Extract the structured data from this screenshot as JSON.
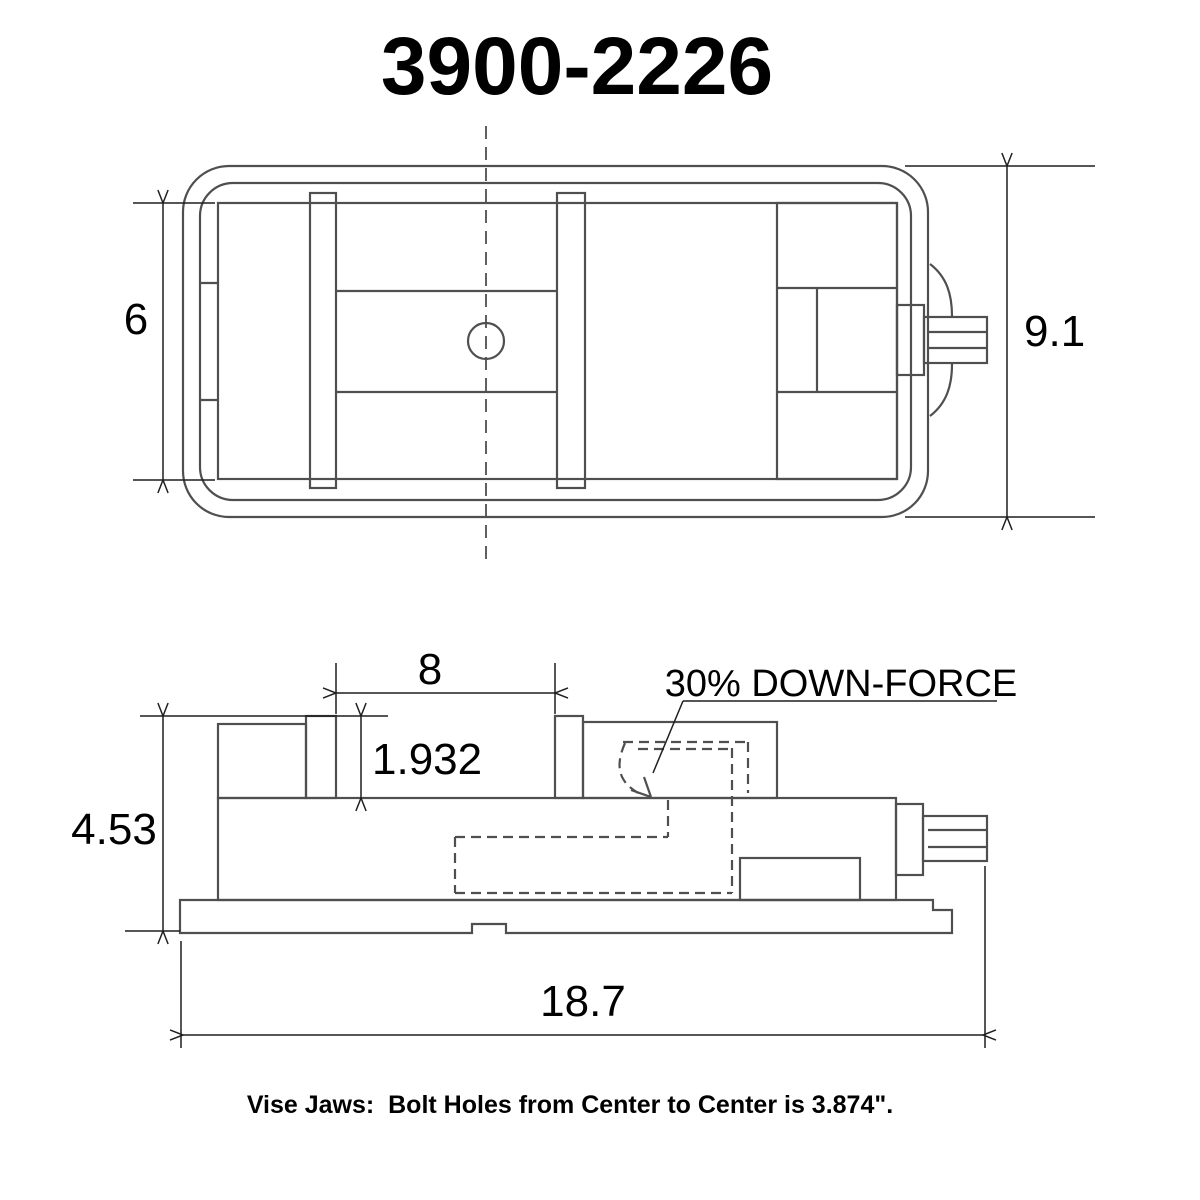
{
  "title": "3900-2226",
  "top_view": {
    "bed_width_dim": "6",
    "overall_width_dim": "9.1"
  },
  "side_view": {
    "jaw_opening_dim": "8",
    "jaw_height_dim": "1.932",
    "overall_height_dim": "4.53",
    "overall_length_dim": "18.7",
    "down_force_label": "30% DOWN-FORCE"
  },
  "footnote": "Vise Jaws:  Bolt Holes from Center to Center is 3.874\".",
  "colors": {
    "drawing_line": "#4f4f4f",
    "dimension_line": "#1f1f1f",
    "text_color": "#000000",
    "background": "#ffffff"
  }
}
